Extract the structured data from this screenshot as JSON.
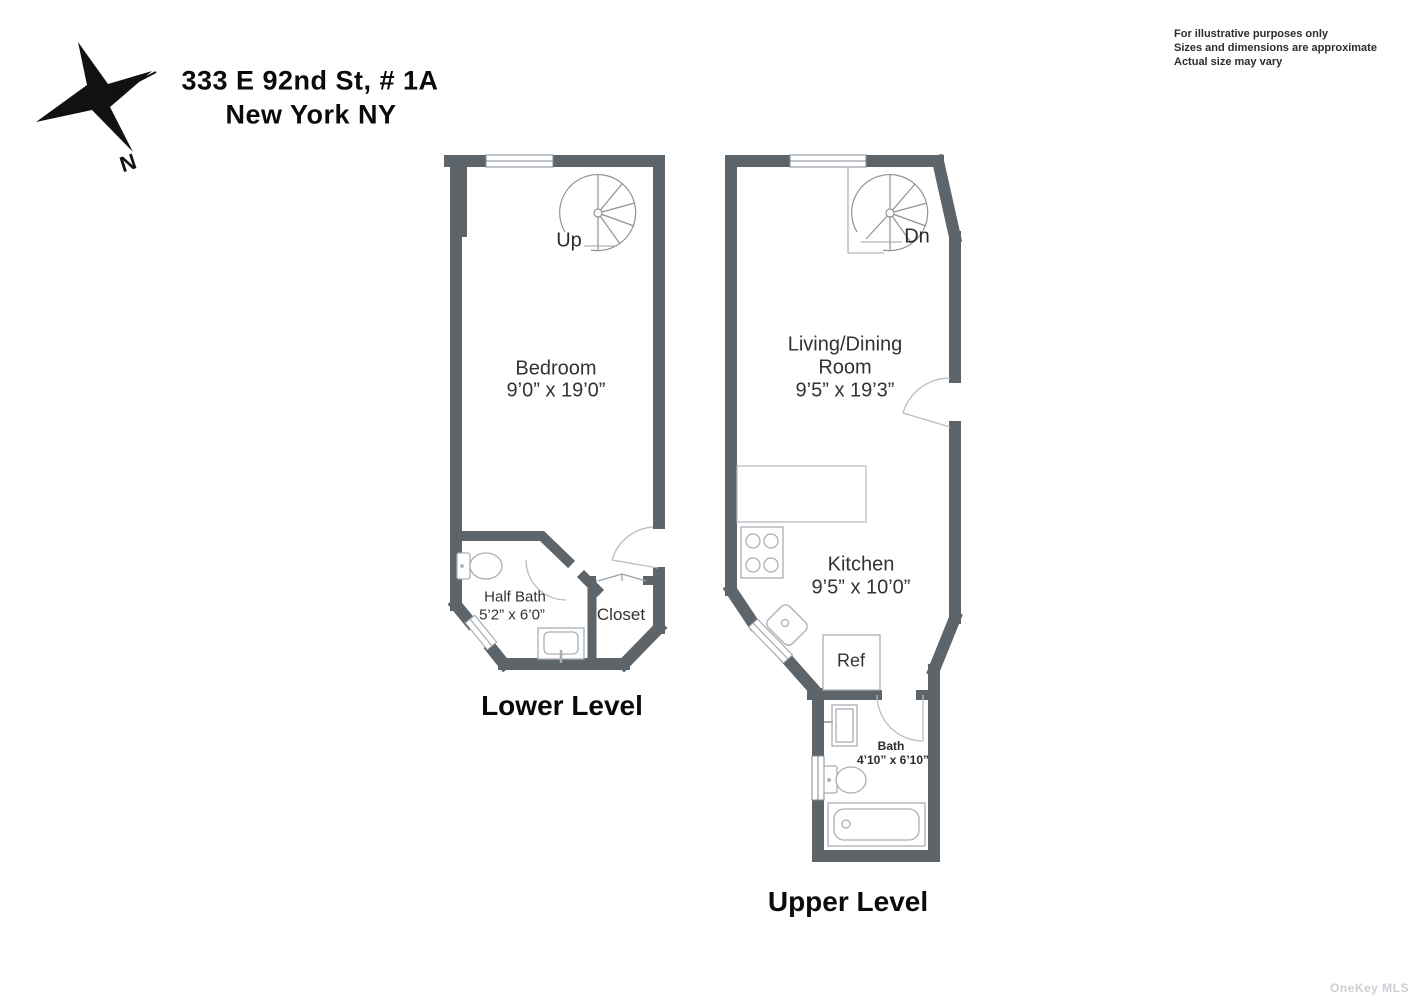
{
  "header": {
    "address_line1": "333 E 92nd St, # 1A",
    "address_line2": "New York NY"
  },
  "disclaimer": {
    "line1": "For illustrative purposes only",
    "line2": "Sizes and dimensions are approximate",
    "line3": "Actual size may vary"
  },
  "compass": {
    "north_label": "N"
  },
  "lower_level": {
    "title": "Lower Level",
    "stair_label": "Up",
    "bedroom_name": "Bedroom",
    "bedroom_dims": "9’0” x 19’0”",
    "half_bath_name": "Half Bath",
    "half_bath_dims": "5’2” x 6’0”",
    "closet_name": "Closet"
  },
  "upper_level": {
    "title": "Upper Level",
    "stair_label": "Dn",
    "living_dining_line1": "Living/Dining",
    "living_dining_line2": "Room",
    "living_dining_dims": "9’5” x 19’3”",
    "kitchen_name": "Kitchen",
    "kitchen_dims": "9’5” x 10’0”",
    "ref_label": "Ref",
    "bath_name": "Bath",
    "bath_dims": "4’10” x 6’10”"
  },
  "watermark": "OneKey MLS",
  "colors": {
    "wall": "#5e656a",
    "fixture": "#a9aeb3",
    "door_arc": "#b9bdc1",
    "stair_line": "#8d9398",
    "text": "#333333",
    "watermark": "#c9ced3"
  }
}
